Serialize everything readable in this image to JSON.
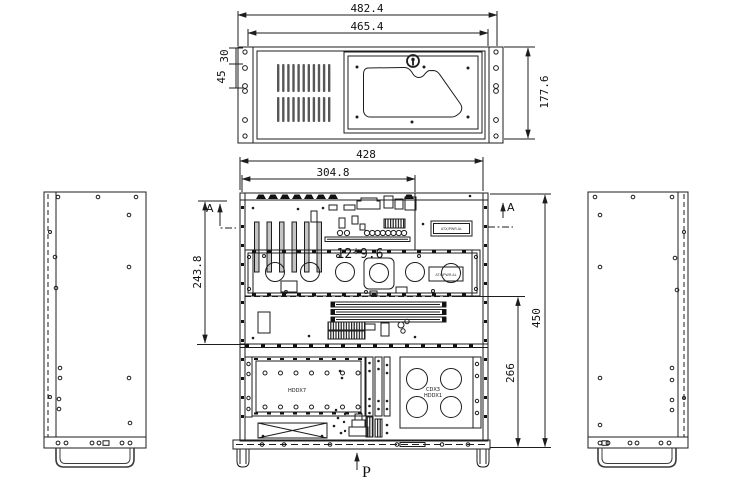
{
  "front_view": {
    "dim_overall_width": "482.4",
    "dim_mount_width": "465.4",
    "dim_height": "177.6",
    "dim_ear_hole_30": "30",
    "dim_ear_hole_45": "45"
  },
  "top_view": {
    "dim_overall_width": "428",
    "dim_board_width": "304.8",
    "dim_rear_depth": "243.8",
    "dim_overall_depth": "450",
    "dim_front_depth": "266",
    "motherboard_size": "12*9.6",
    "section_label": "A",
    "load_arrow_label": "P",
    "hdd_bay_label": "HDDX7",
    "cd_bay_label_line1": "CDX3",
    "cd_bay_label_line2": "HDDX1",
    "rear_plate_label": "ATX/PWR.AL",
    "mid_plate_label": "ATX/PWR.AL"
  }
}
